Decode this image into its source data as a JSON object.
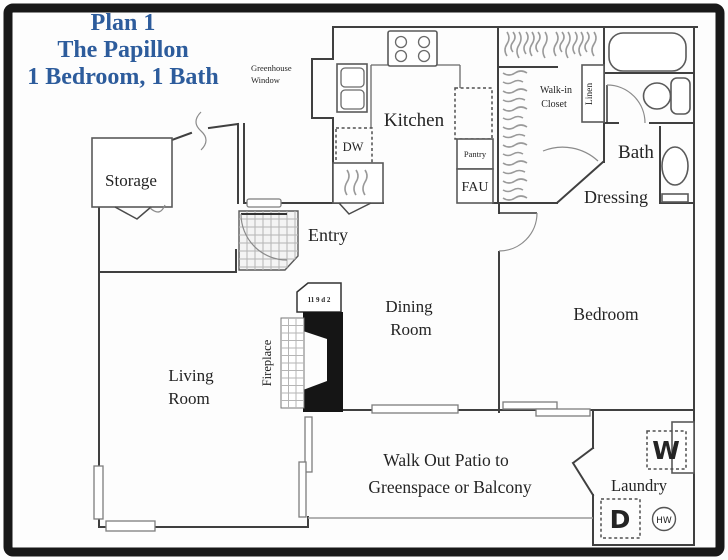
{
  "title": {
    "line1": "Plan 1",
    "line2": "The Papillon",
    "line3": "1 Bedroom, 1 Bath"
  },
  "labels": {
    "storage": "Storage",
    "entry": "Entry",
    "kitchen": "Kitchen",
    "dining_line1": "Dining",
    "dining_line2": "Room",
    "living_line1": "Living",
    "living_line2": "Room",
    "bedroom": "Bedroom",
    "bath": "Bath",
    "dressing": "Dressing",
    "walkin_line1": "Walk-in",
    "walkin_line2": "Closet",
    "linen": "Linen",
    "laundry": "Laundry",
    "pantry": "Pantry",
    "fau": "FAU",
    "dw": "DW",
    "washer": "W",
    "dryer": "D",
    "hot_water": "HW",
    "fireplace": "Fireplace",
    "fireplace_niche": "11 9 d 2",
    "greenhouse_line1": "Greenhouse",
    "greenhouse_line2": "Window",
    "patio_line1": "Walk Out Patio to",
    "patio_line2": "Greenspace or Balcony"
  },
  "colors": {
    "title_blue": "#2d5c9c",
    "wall": "#404040",
    "fireplace_fill": "#151515",
    "border": "#181818",
    "patio_edge": "#9a9a9a"
  }
}
